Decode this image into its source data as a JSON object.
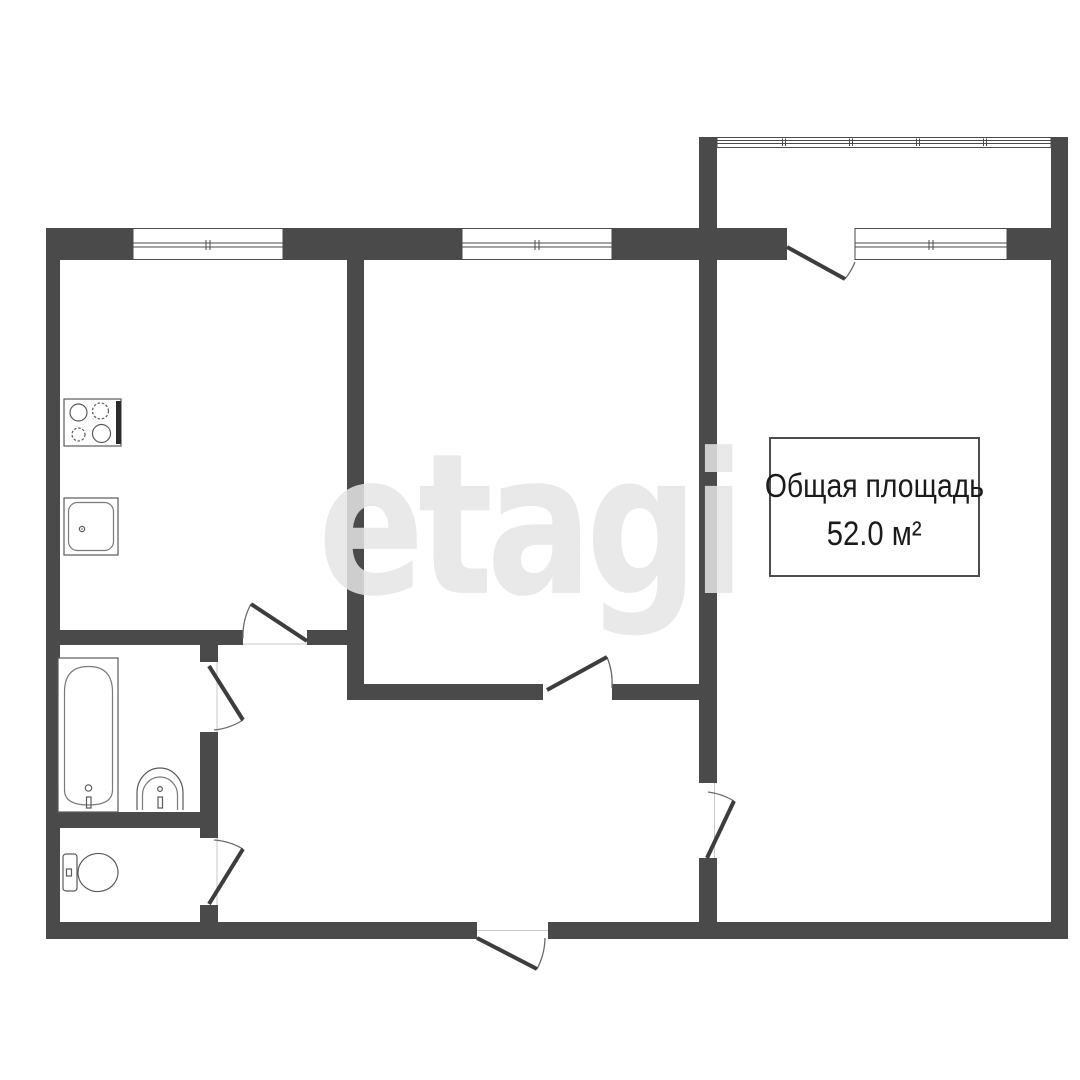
{
  "plan": {
    "type": "apartment-floor-plan",
    "watermark": {
      "text": "etagi",
      "color": "#e5e5e5"
    },
    "area_label": {
      "line1": "Общая площадь",
      "line2": "52.0 м²"
    },
    "colors": {
      "wall": "#4a4a4a",
      "background": "#ffffff",
      "fixture_stroke": "#5a5a5a",
      "door_leaf": "#3d3d3d",
      "door_arc": "#6a6a6a",
      "threshold": "#c9c9c9"
    },
    "fixtures": {
      "stove_icon": "stove-icon",
      "kitchen_sink_icon": "kitchen-sink-icon",
      "bathtub_icon": "bathtub-icon",
      "washbasin_icon": "washbasin-icon",
      "toilet_icon": "toilet-icon"
    },
    "rooms": {
      "windows_count": 4,
      "doors_count": 7
    }
  }
}
